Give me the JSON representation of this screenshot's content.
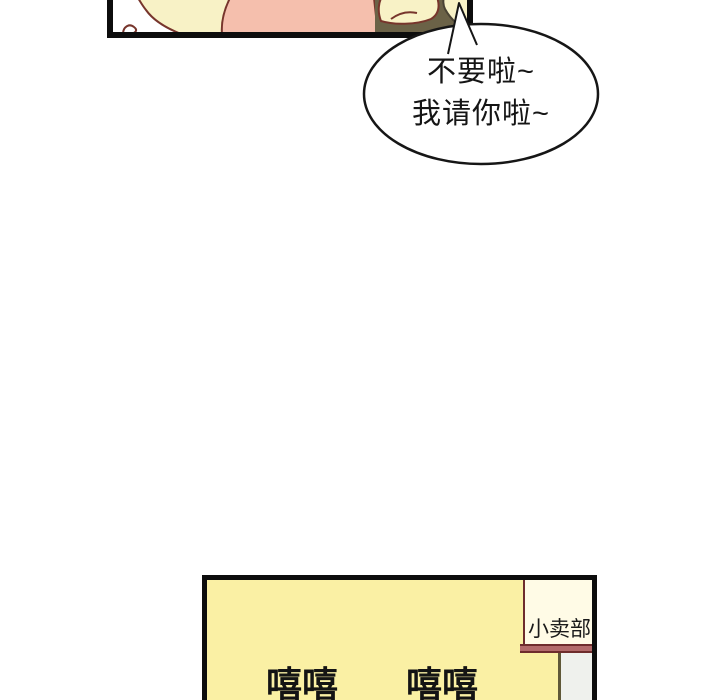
{
  "page": {
    "type": "webtoon-comic-crop",
    "background": "#ffffff"
  },
  "top_panel": {
    "colors": {
      "panel_border": "#0d0d0d",
      "line_art_outline": "#77352C",
      "skin_tone": "#F8F2C6",
      "pink_clothing": "#F5BFAD",
      "olive_shadow": "#6B6247"
    }
  },
  "speech_bubble": {
    "fill": "#ffffff",
    "outline": "#161616",
    "lines": [
      "不要啦~",
      "我请你啦~"
    ]
  },
  "bottom_panel": {
    "background": "#FAF0A4",
    "border": "#0d0d0d",
    "shop_sign": {
      "label": "小卖部",
      "fill": "#FFFBE6",
      "trim": "#6E2C2C",
      "bar_fill": "#B26A6A"
    },
    "doorway_strip_fill": "#EFF1ED",
    "sfx": [
      "嘻嘻",
      "嘻嘻"
    ]
  }
}
